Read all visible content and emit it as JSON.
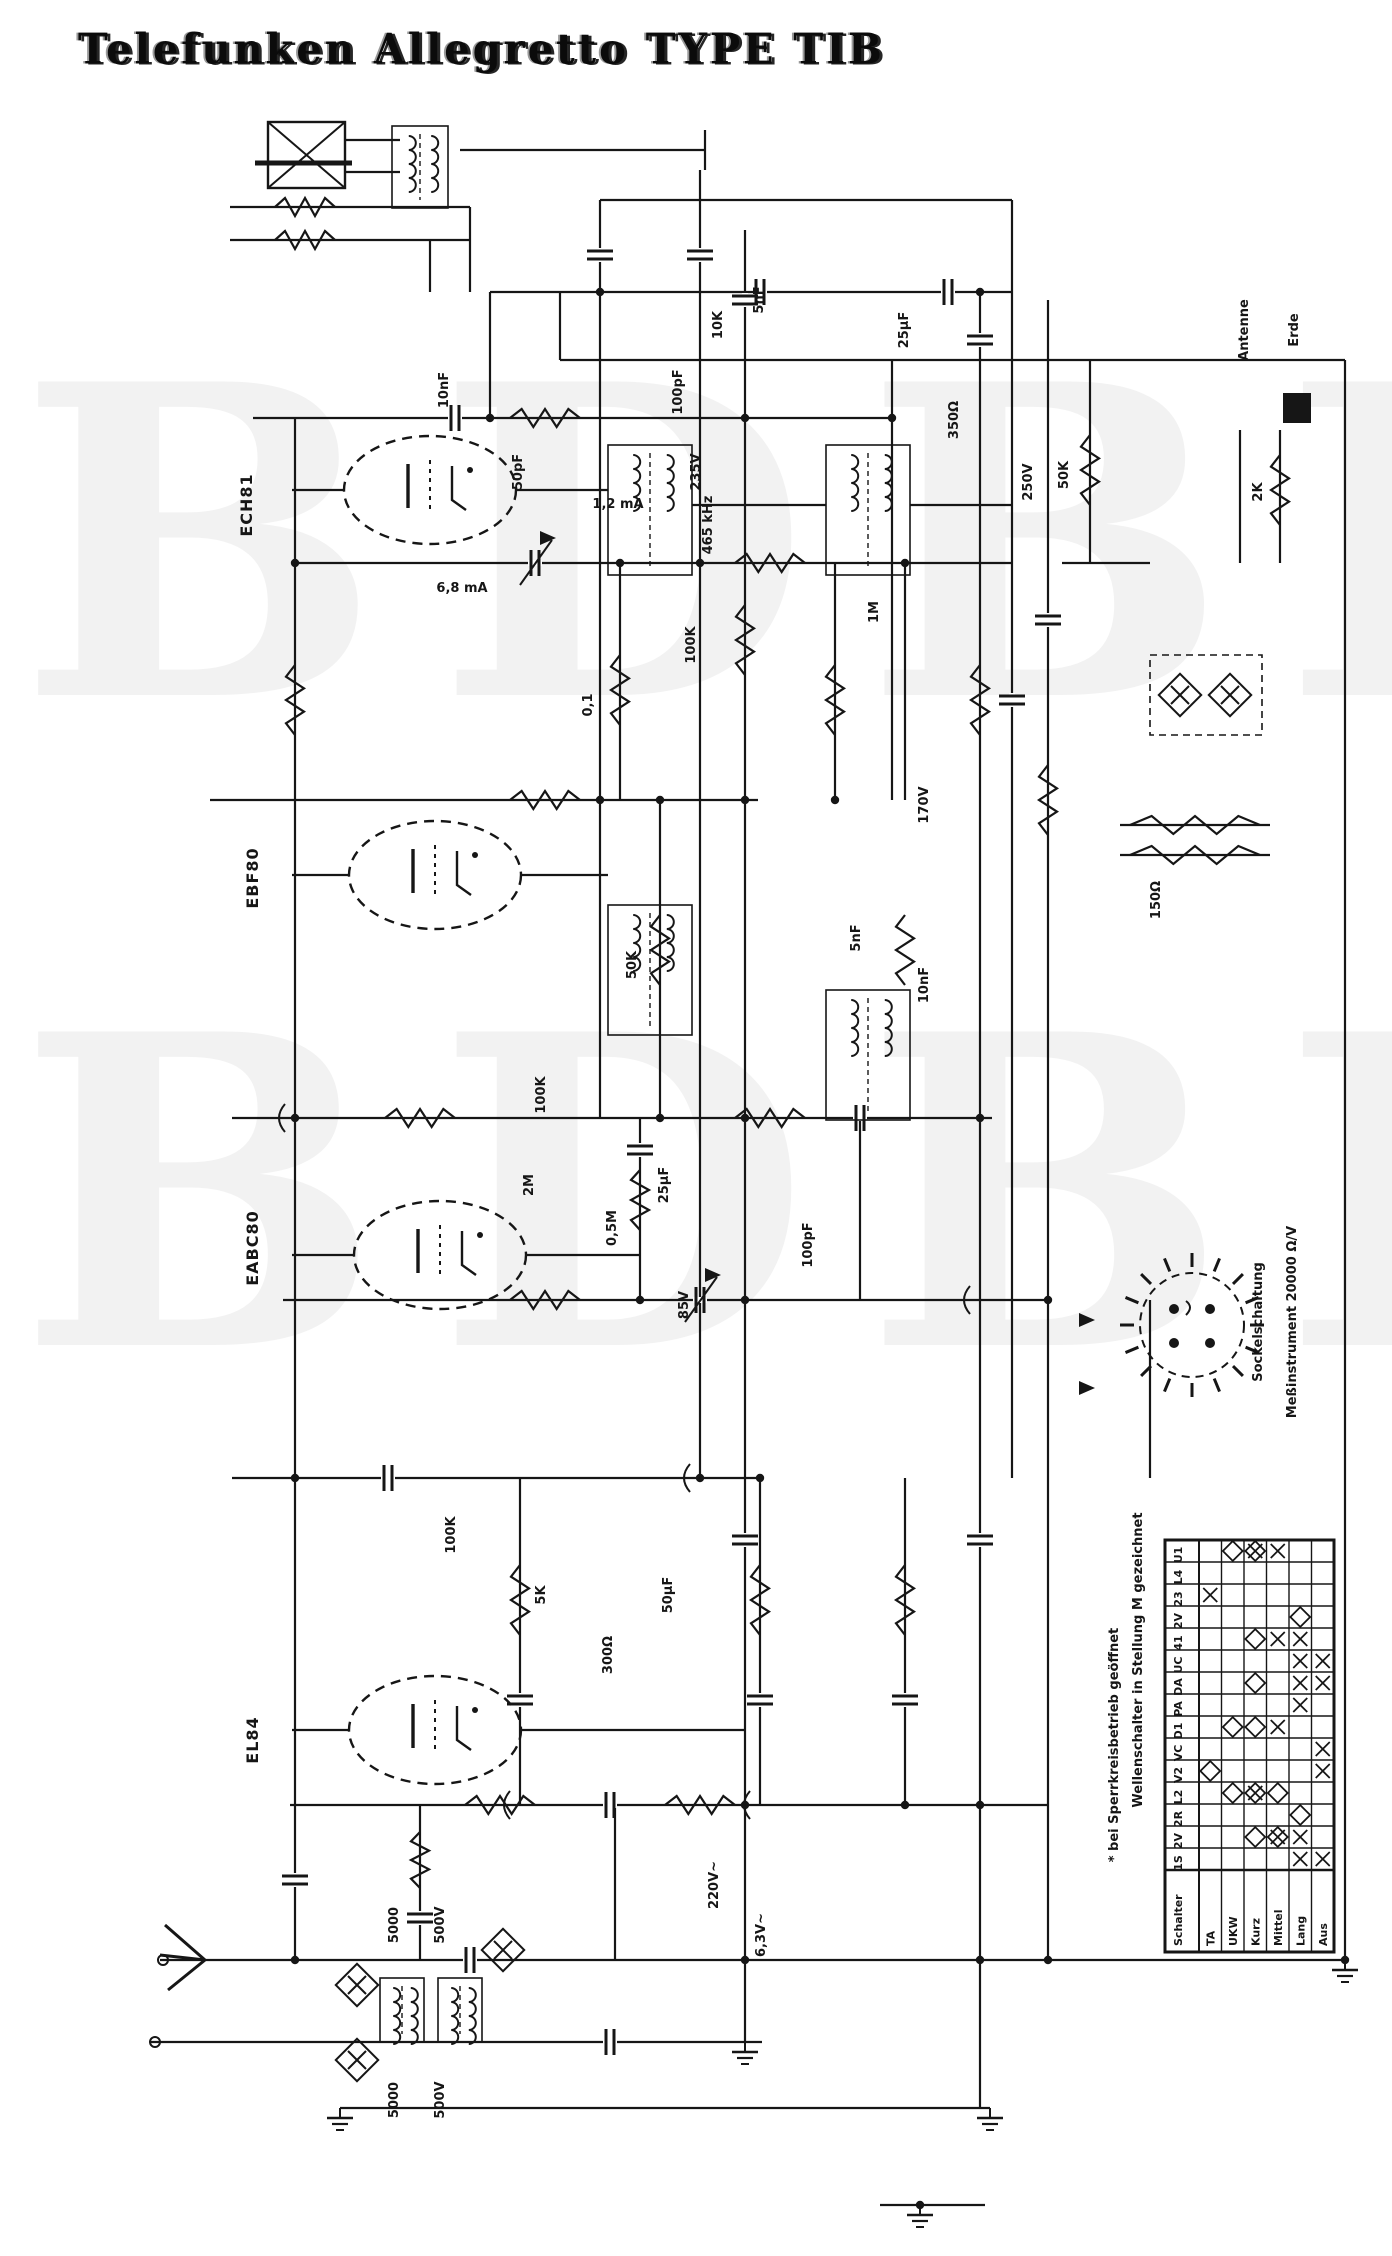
{
  "title": "Telefunken  Allegretto  TYPE TIB",
  "watermark": {
    "row1": "BDBB",
    "row2": "BDBB"
  },
  "tubes": {
    "t1": "ECH81",
    "t2": "EBF80",
    "t3": "EABC80",
    "t4": "EL84"
  },
  "notes": {
    "socket_caption": "Sockelschaltung",
    "meter_caption": "Meßinstrument 20000 Ω/V",
    "footnote_star": "* bei Sperrkreisbetrieb geöffnet",
    "footnote_switch": "Wellenschalter in Stellung M gezeichnet"
  },
  "component_labels": [
    {
      "t": "10nF",
      "x": 448,
      "y": 390
    },
    {
      "t": "50pF",
      "x": 522,
      "y": 472
    },
    {
      "t": "100pF",
      "x": 682,
      "y": 392
    },
    {
      "t": "10K",
      "x": 722,
      "y": 325
    },
    {
      "t": "5nF",
      "x": 763,
      "y": 300
    },
    {
      "t": "25µF",
      "x": 908,
      "y": 330
    },
    {
      "t": "350Ω",
      "x": 958,
      "y": 420
    },
    {
      "t": "465 kHz",
      "x": 712,
      "y": 525
    },
    {
      "t": "0,1",
      "x": 592,
      "y": 705
    },
    {
      "t": "100K",
      "x": 695,
      "y": 645
    },
    {
      "t": "1M",
      "x": 878,
      "y": 612
    },
    {
      "t": "50K",
      "x": 1068,
      "y": 475
    },
    {
      "t": "2K",
      "x": 1262,
      "y": 492
    },
    {
      "t": "235V",
      "x": 700,
      "y": 472
    },
    {
      "t": "250V",
      "x": 1032,
      "y": 482
    },
    {
      "t": "50K",
      "x": 636,
      "y": 965
    },
    {
      "t": "5nF",
      "x": 860,
      "y": 938
    },
    {
      "t": "10nF",
      "x": 928,
      "y": 985
    },
    {
      "t": "100K",
      "x": 545,
      "y": 1095
    },
    {
      "t": "170V",
      "x": 928,
      "y": 805
    },
    {
      "t": "2M",
      "x": 533,
      "y": 1185
    },
    {
      "t": "25µF",
      "x": 668,
      "y": 1185
    },
    {
      "t": "100pF",
      "x": 812,
      "y": 1245
    },
    {
      "t": "0,5M",
      "x": 616,
      "y": 1228
    },
    {
      "t": "85V",
      "x": 688,
      "y": 1305
    },
    {
      "t": "100K",
      "x": 455,
      "y": 1535
    },
    {
      "t": "5K",
      "x": 545,
      "y": 1595
    },
    {
      "t": "50µF",
      "x": 672,
      "y": 1595
    },
    {
      "t": "300Ω",
      "x": 612,
      "y": 1655
    },
    {
      "t": "150Ω",
      "x": 1160,
      "y": 900
    },
    {
      "t": "5000",
      "x": 398,
      "y": 1925
    },
    {
      "t": "500V",
      "x": 444,
      "y": 1925
    },
    {
      "t": "5000",
      "x": 398,
      "y": 2100
    },
    {
      "t": "500V",
      "x": 444,
      "y": 2100
    },
    {
      "t": "220V~",
      "x": 718,
      "y": 1885
    },
    {
      "t": "6,3V~",
      "x": 765,
      "y": 1935
    },
    {
      "t": "Antenne",
      "x": 1248,
      "y": 330
    },
    {
      "t": "Erde",
      "x": 1298,
      "y": 330
    },
    {
      "t": "1,2 mA",
      "x": 618,
      "y": 508,
      "rot": false
    },
    {
      "t": "6,8 mA",
      "x": 462,
      "y": 592,
      "rot": false
    }
  ],
  "switch_table": {
    "header_col": "Schalter",
    "columns": [
      "TA",
      "UKW",
      "Kurz",
      "Mittel",
      "Lang",
      "Aus"
    ],
    "rows": [
      {
        "label": "U1",
        "marks": ".dbx.."
      },
      {
        "label": "L4",
        "marks": "......"
      },
      {
        "label": "23",
        "marks": "x....."
      },
      {
        "label": "2V",
        "marks": "....d."
      },
      {
        "label": "41",
        "marks": "..dxx."
      },
      {
        "label": "UC",
        "marks": "....xx"
      },
      {
        "label": "DA",
        "marks": "..d.xx"
      },
      {
        "label": "PA",
        "marks": "....x."
      },
      {
        "label": "D1",
        "marks": ".ddx.."
      },
      {
        "label": "VC",
        "marks": ".....x"
      },
      {
        "label": "V2",
        "marks": "d....x"
      },
      {
        "label": "L2",
        "marks": ".dbd.."
      },
      {
        "label": "2R",
        "marks": "....d."
      },
      {
        "label": "2V",
        "marks": "..dbx."
      },
      {
        "label": "1S",
        "marks": "....xx"
      }
    ]
  }
}
